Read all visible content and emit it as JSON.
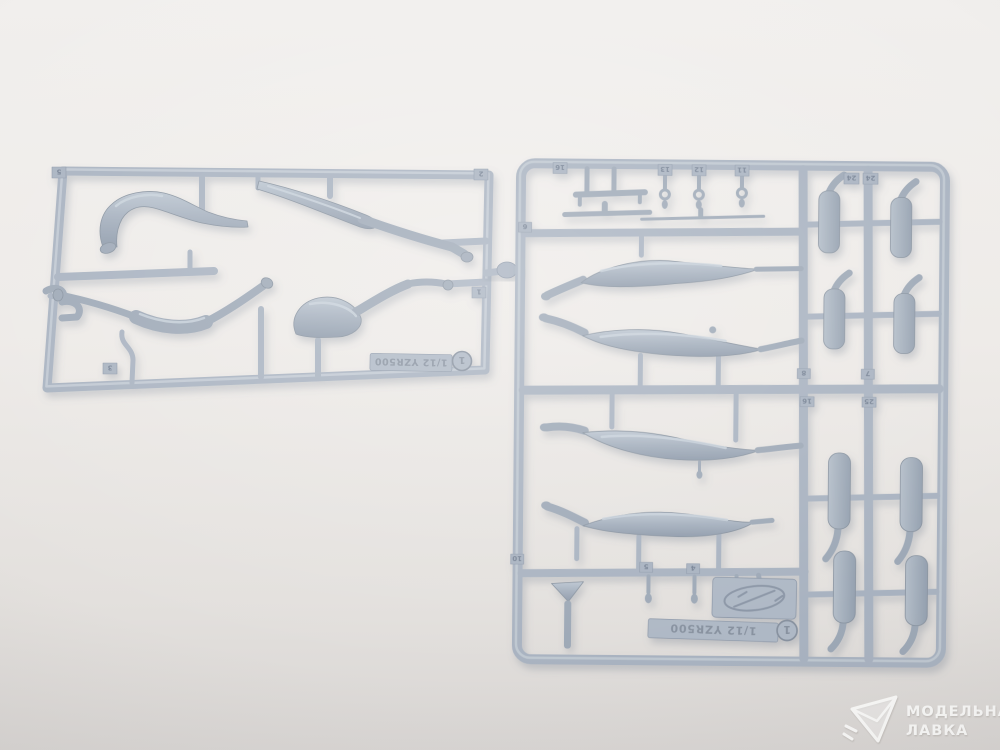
{
  "photo": {
    "background_hex": "#edeae7",
    "sprue_plastic_hex": "#a8b2c0",
    "part_plastic_hex": "#9da8b6",
    "shadow_hex": "#6b7688"
  },
  "left_sprue": {
    "mold_text": "1/12 YZR500",
    "gate_badge": "1",
    "tag_top_left": "5",
    "tag_top_right": "2",
    "tag_right_edge": "1",
    "tag_bottom_left": "3"
  },
  "right_sprue": {
    "mold_text": "1/12 YZR500",
    "gate_badge": "1",
    "tag_row_top": [
      "16",
      "13",
      "12",
      "11"
    ],
    "tag_left_rail": "6",
    "tag_col_upper": [
      "24",
      "24"
    ],
    "tag_mid_upper": [
      "8",
      "7"
    ],
    "tag_mid_lower": [
      "16",
      "25"
    ],
    "tag_row_bottom": [
      "10",
      "5",
      "4"
    ]
  },
  "watermark": {
    "shop_line1": "МОДЕЛЬНАЯ",
    "shop_line2": "ЛАВКА"
  }
}
